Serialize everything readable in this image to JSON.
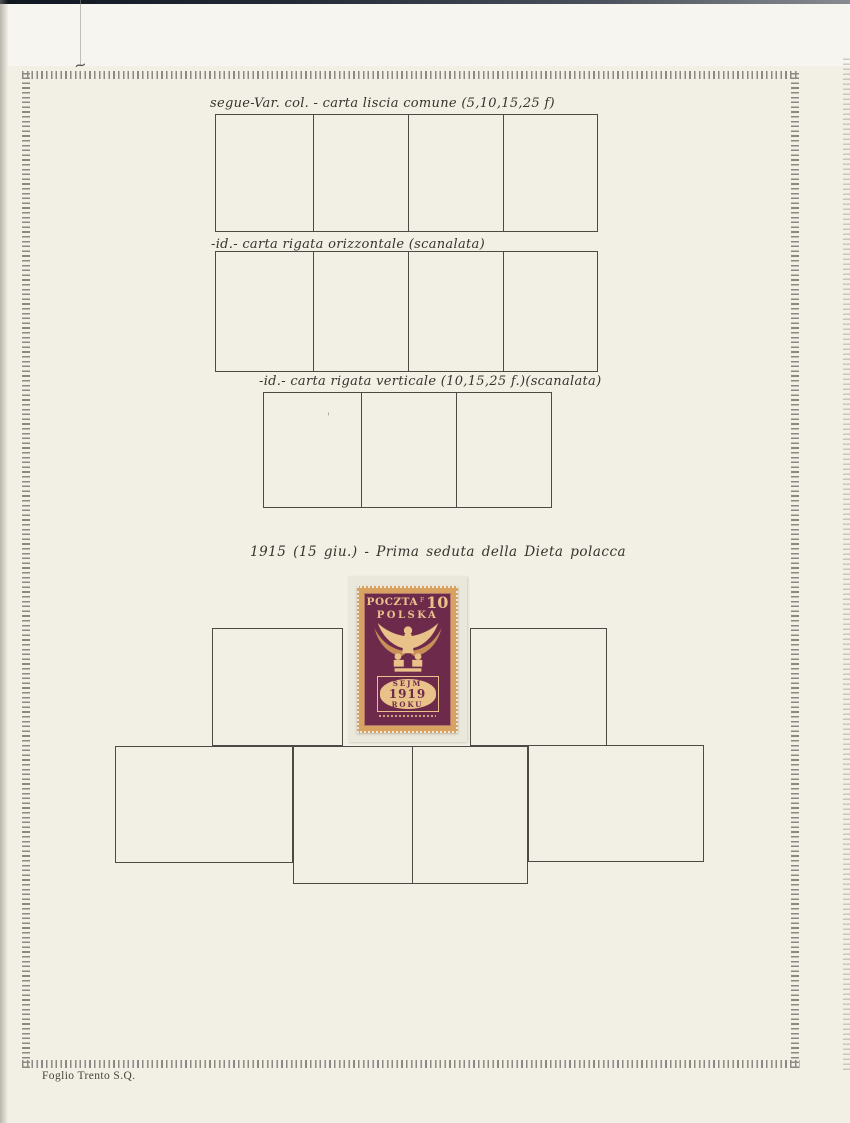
{
  "colors": {
    "paper": "#f2efe5",
    "paper_top": "#f7f5ef",
    "box_line": "#4c4a44",
    "handwriting_ink": "#35332d",
    "border_tick": "#8b8a84",
    "stamp_tan": "#d9a261",
    "stamp_tan_light": "#e9c28a",
    "stamp_claret": "#6e2a4b",
    "mount_card": "#eae7db",
    "footer_ink": "#45423a",
    "scan_strip": "#1d2631"
  },
  "captions": {
    "row1": "segue-Var. col. - carta liscia comune (5,10,15,25 f)",
    "row2": "-id.- carta rigata orizzontale (scanalata)",
    "row3": "-id.- carta rigata verticale (10,15,25 f.)(scanalata)",
    "stamp_row": "1915 (15 giu.) - Prima seduta della Dieta polacca"
  },
  "stamp": {
    "header_word": "POCZTA",
    "currency_letter": "F",
    "denomination": "10",
    "subheader_word": "POLSKA",
    "tablet_line1": "SEJM",
    "tablet_year": "1919",
    "tablet_line3": "ROKU"
  },
  "footer": {
    "label": "Foglio Trento S.Q."
  },
  "decorations": {
    "corner_mark": "~",
    "cell_speck": "'"
  }
}
